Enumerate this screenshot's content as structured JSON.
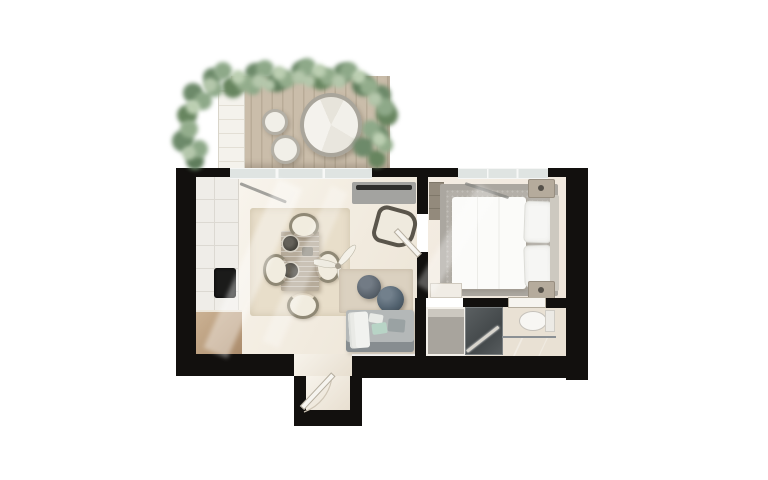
{
  "scene": {
    "kind": "3d-rendered-apartment-floor-plan",
    "visible_text": "none",
    "background_color": "#ffffff",
    "wall_color": "#12100e",
    "floor_color": "#f4eee4",
    "deck_color": "#cabdaa",
    "foliage_colors": [
      "#6d8a6a",
      "#8ea989",
      "#b4c7ab"
    ],
    "accent_colors": {
      "mint_pillow": "#b8d4c6",
      "marble_vanity": "#5f656b",
      "wood_cabinet": "#b99c7c"
    }
  },
  "rooms": [
    {
      "id": "terrace",
      "position": "top",
      "furniture": [
        "planting-border",
        "wood-deck",
        "lounger-mat",
        "round-daybed",
        "round-side-table",
        "round-side-table"
      ]
    },
    {
      "id": "living-kitchen",
      "position": "left",
      "furniture": [
        "kitchen-counter",
        "cooktop",
        "corner-wood-cabinet",
        "dining-rug",
        "dining-table",
        "dining-chair",
        "dining-chair",
        "dining-chair",
        "dining-chair",
        "ceiling-fan",
        "tv-console",
        "armchair",
        "lounge-rug",
        "pouf",
        "ball-pouf",
        "sofa-with-pillows"
      ]
    },
    {
      "id": "bedroom",
      "position": "right",
      "furniture": [
        "wardrobe",
        "area-rug",
        "double-bed",
        "pillows",
        "headboard",
        "nightstand",
        "nightstand",
        "vanity-bench"
      ]
    },
    {
      "id": "bathroom",
      "position": "bottom-right",
      "furniture": [
        "walk-in-shower",
        "stone-vanity-counter",
        "toilet"
      ]
    },
    {
      "id": "entry-vestibule",
      "position": "bottom-center",
      "furniture": [
        "entrance-door"
      ]
    }
  ]
}
